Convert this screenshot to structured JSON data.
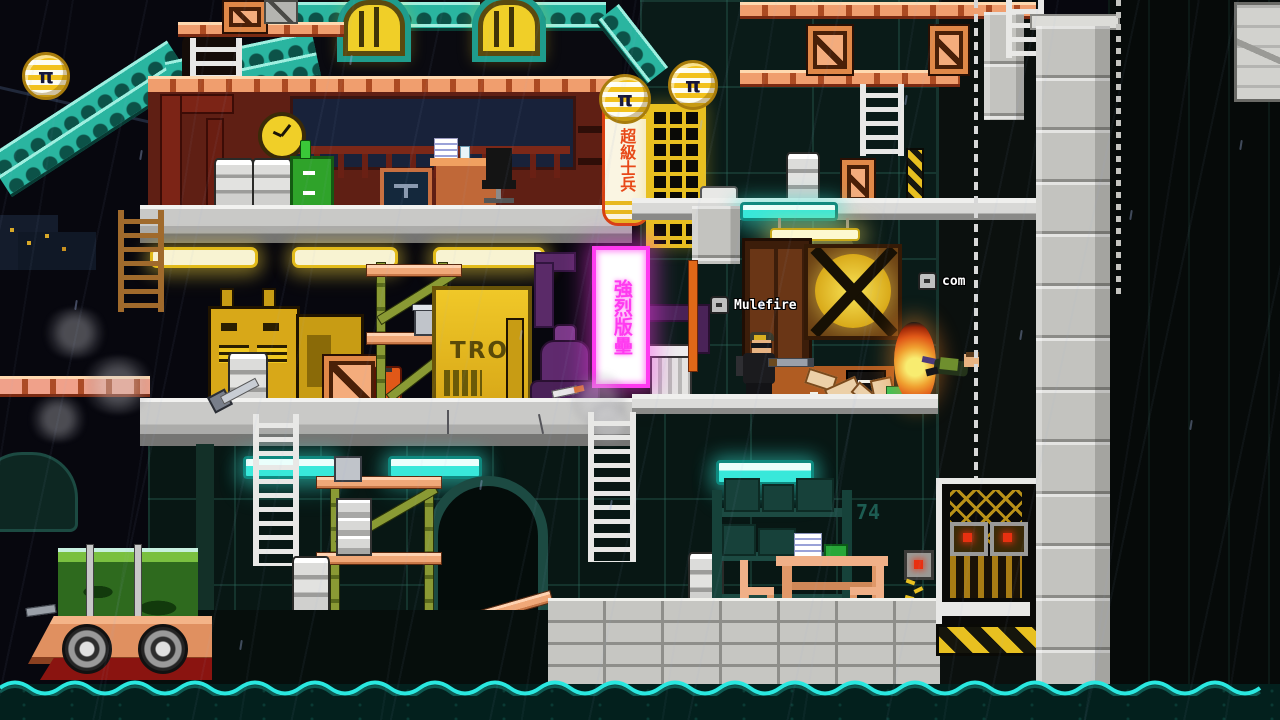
{
  "players": [
    {
      "name": "Mulefire"
    },
    {
      "name": "com"
    }
  ],
  "signs": {
    "vertical_yellow_sign": "超級士兵",
    "vertical_pink_neon": "強烈版壘",
    "billboard_partial": "TRO",
    "basement_wall_number": "74",
    "coin_symbol": "π"
  },
  "colors": {
    "night-sky": "#07070e",
    "roof-teal": "#2ab5a0",
    "roof-teal-light": "#9fefe0",
    "neon-pink": "#ff3af0",
    "neon-yellow": "#f0cf28",
    "light-cyan": "#38e8da",
    "salmon": "#f09e6e",
    "gold": "#d8a818",
    "maroon": "#5f1f14",
    "fire-orange": "#f09030",
    "water-cyan": "#2ae8e0",
    "brick-grey": "#c6c6c2"
  }
}
